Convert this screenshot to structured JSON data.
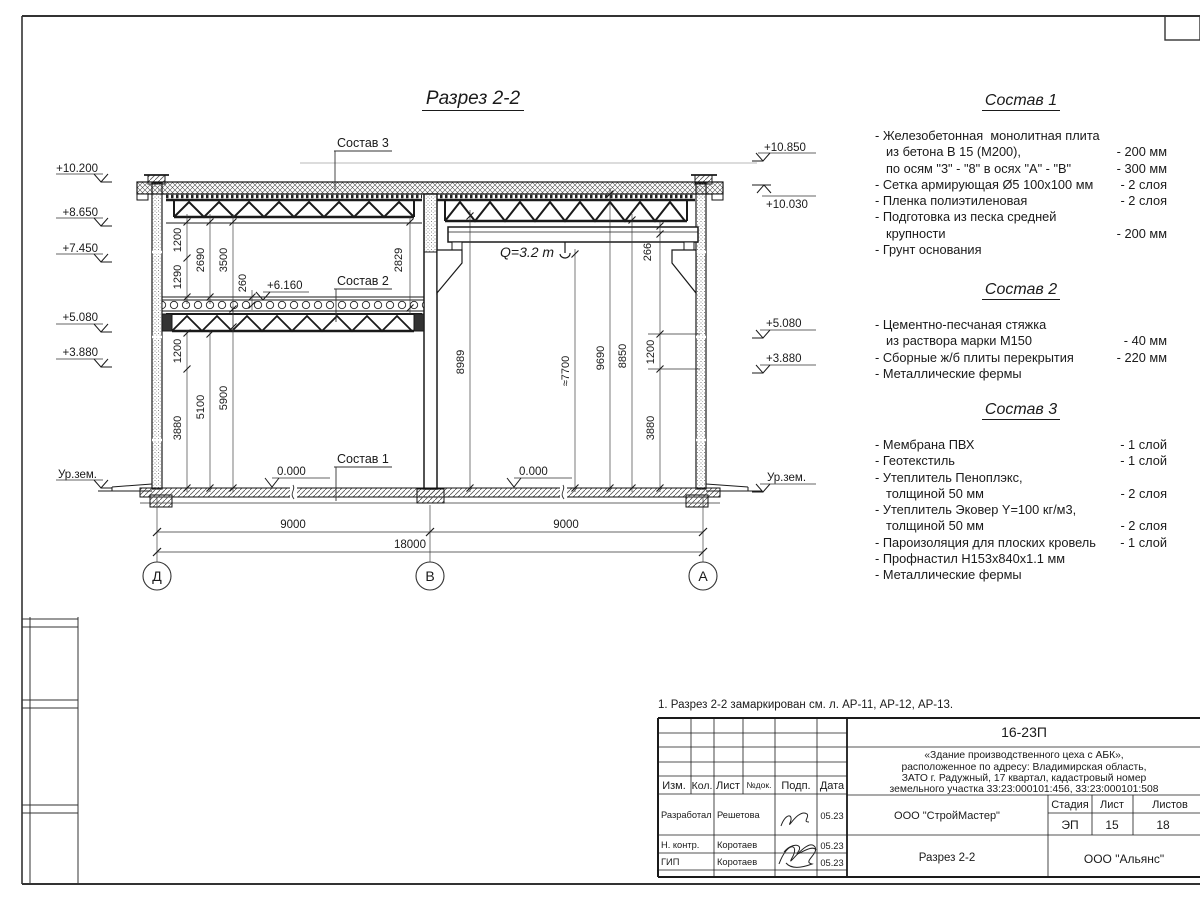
{
  "page": {
    "title": "Разрез 2-2",
    "note": "1. Разрез 2-2 замаркирован см. л. АР-11, АР-12, АР-13."
  },
  "drawing": {
    "levels_left": [
      "+10.200",
      "+8.650",
      "+7.450",
      "+5.080",
      "+3.880",
      "Ур.зем."
    ],
    "levels_right": [
      "+10.850",
      "+10.030",
      "+5.080",
      "+3.880",
      "Ур.зем."
    ],
    "level_mid": "+6.160",
    "zero_left": "0.000",
    "zero_right": "0.000",
    "crane_label": "Q=3.2 т",
    "leaders": {
      "s1": "Состав 1",
      "s2": "Состав 2",
      "s3": "Состав 3"
    },
    "dims": {
      "upper_left": [
        "1200",
        "1290",
        "2690",
        "3500",
        "260",
        "2829"
      ],
      "lower_left": [
        "1200",
        "3880",
        "5100",
        "5900"
      ],
      "right": [
        "8989",
        "≈7700",
        "9690",
        "8850",
        "1200",
        "3880",
        "266"
      ],
      "bottom": [
        "9000",
        "9000",
        "18000"
      ]
    },
    "axes": [
      "Д",
      "В",
      "А"
    ]
  },
  "s1": {
    "title": "Состав 1",
    "lines": [
      {
        "t": "- Железобетонная  монолитная плита",
        "v": ""
      },
      {
        "t": "из бетона В 15 (М200),",
        "v": "- 200 мм"
      },
      {
        "t": "по осям \"3\" - \"8\" в осях \"А\" - \"В\"",
        "v": "- 300 мм"
      },
      {
        "t": "- Сетка армирующая Ø5 100х100 мм",
        "v": "- 2 слоя"
      },
      {
        "t": "- Пленка полиэтиленовая",
        "v": "- 2 слоя"
      },
      {
        "t": "- Подготовка из песка средней",
        "v": ""
      },
      {
        "t": "крупности",
        "v": "- 200 мм"
      },
      {
        "t": "- Грунт основания",
        "v": ""
      }
    ]
  },
  "s2": {
    "title": "Состав 2",
    "lines": [
      {
        "t": "- Цементно-песчаная стяжка",
        "v": ""
      },
      {
        "t": "из раствора марки М150",
        "v": "- 40 мм"
      },
      {
        "t": "- Сборные ж/б плиты перекрытия",
        "v": "- 220 мм"
      },
      {
        "t": "- Металлические фермы",
        "v": ""
      }
    ]
  },
  "s3": {
    "title": "Состав 3",
    "lines": [
      {
        "t": "- Мембрана ПВХ",
        "v": "- 1 слой"
      },
      {
        "t": "- Геотекстиль",
        "v": "- 1 слой"
      },
      {
        "t": "- Утеплитель Пеноплэкс,",
        "v": ""
      },
      {
        "t": "толщиной 50 мм",
        "v": "- 2 слоя"
      },
      {
        "t": "- Утеплитель Эковер Y=100 кг/м3,",
        "v": ""
      },
      {
        "t": "толщиной 50 мм",
        "v": "- 2 слоя"
      },
      {
        "t": "- Пароизоляция для плоских кровель",
        "v": "- 1 слой"
      },
      {
        "t": "- Профнастил Н153х840х1.1 мм",
        "v": ""
      },
      {
        "t": "- Металлические фермы",
        "v": ""
      }
    ]
  },
  "tb": {
    "doc": "16-23П",
    "desc": [
      "«Здание производственного цеха с АБК»,",
      "расположенное по адресу: Владимирская область,",
      "ЗАТО г. Радужный, 17 квартал, кадастровый номер",
      "земельного участка 33:23:000101:456, 33:23:000101:508"
    ],
    "cols": [
      "Изм.",
      "Кол.",
      "Лист",
      "№док.",
      "Подп.",
      "Дата"
    ],
    "rows": [
      {
        "r": "Разработал",
        "n": "Решетова",
        "d": "05.23"
      },
      {
        "r": "Н. контр.",
        "n": "Коротаев",
        "d": "05.23"
      },
      {
        "r": "ГИП",
        "n": "Коротаев",
        "d": "05.23"
      }
    ],
    "org1": "ООО \"СтройМастер\"",
    "stage_cols": [
      "Стадия",
      "Лист",
      "Листов"
    ],
    "stage": "ЭП",
    "sheet_no": "15",
    "sheets_total": "18",
    "sheet_name": "Разрез 2-2",
    "org2": "ООО \"Альянс\""
  }
}
